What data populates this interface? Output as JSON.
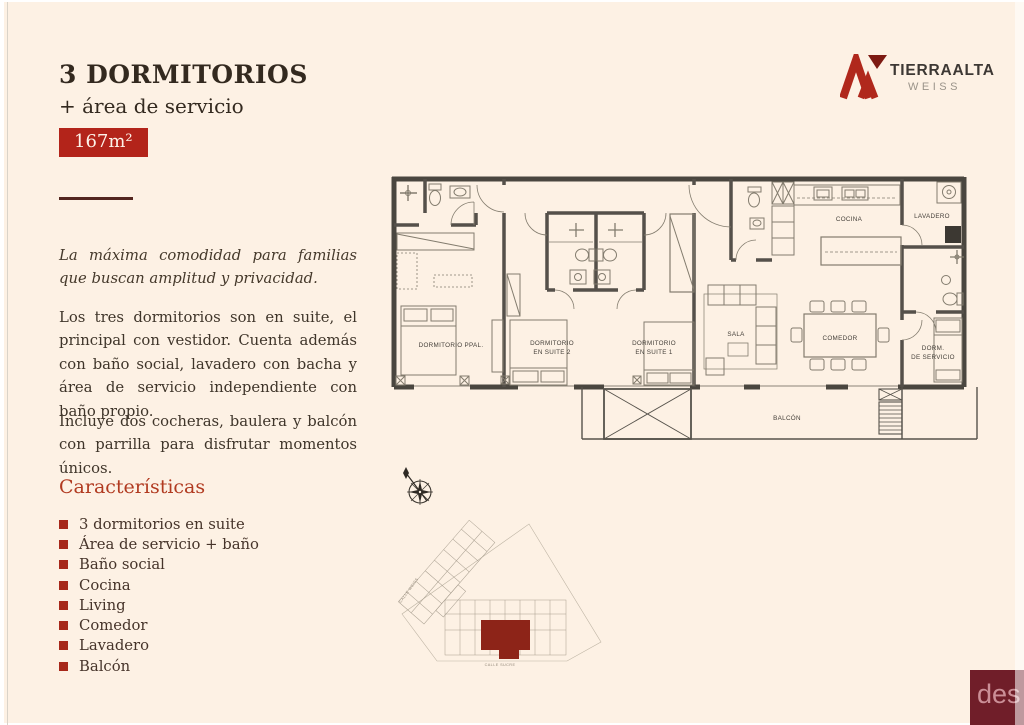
{
  "header": {
    "title": "3 DORMITORIOS",
    "subtitle": "+ área de servicio",
    "area_badge": "167m²"
  },
  "logo": {
    "brand": "TIERRAALTA",
    "sub": "WEISS"
  },
  "intro": {
    "tagline": "La máxima comodidad para familias que buscan amplitud y privacidad.",
    "p1": "Los tres dormitorios son en suite, el principal con vestidor. Cuenta además con baño social, lavadero con bacha y área de servicio independiente con baño propio.",
    "p2": "Incluye dos cocheras, baulera y balcón con parrilla para disfrutar momentos únicos."
  },
  "features": {
    "heading": "Características",
    "items": [
      "3 dormitorios en suite",
      "Área de servicio + baño",
      "Baño social",
      "Cocina",
      "Living",
      "Comedor",
      "Lavadero",
      "Balcón"
    ]
  },
  "plan": {
    "rooms": {
      "dormitorio_ppal": "DORMITORIO PPAL.",
      "suite2_l1": "DORMITORIO",
      "suite2_l2": "EN SUITE 2",
      "suite1_l1": "DORMITORIO",
      "suite1_l2": "EN SUITE 1",
      "sala": "SALA",
      "cocina": "COCINA",
      "comedor": "COMEDOR",
      "lavadero": "LAVADERO",
      "dorm_servicio_l1": "DORM.",
      "dorm_servicio_l2": "DE SERVICIO",
      "balcon": "BALCÓN"
    }
  },
  "siteplan": {
    "street_left": "CALLE WEISS",
    "street_bottom": "CALLE SUCRE"
  },
  "watermark": {
    "text": "des"
  },
  "colors": {
    "accent_red": "#b3241a",
    "feature_bullet": "#a7281a",
    "heading_red": "#b13a20",
    "background_cream": "#fdf1e4",
    "watermark_maroon": "#701e29",
    "plan_wall": "#4a463f",
    "siteplan_unit_red": "#8d2418"
  }
}
